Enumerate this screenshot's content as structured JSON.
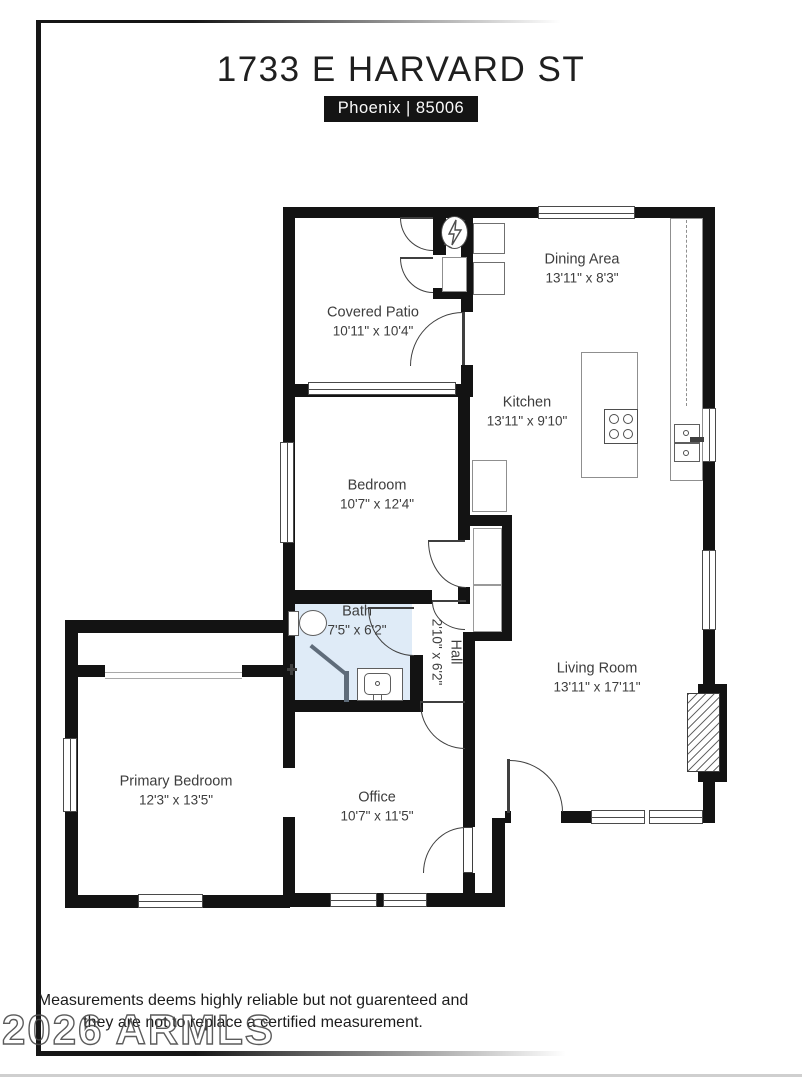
{
  "header": {
    "title": "1733 E HARVARD ST",
    "location": "Phoenix | 85006"
  },
  "rooms": [
    {
      "id": "covered-patio",
      "name": "Covered Patio",
      "dims": "10'11\" x 10'4\""
    },
    {
      "id": "dining-area",
      "name": "Dining Area",
      "dims": "13'11\" x 8'3\""
    },
    {
      "id": "kitchen",
      "name": "Kitchen",
      "dims": "13'11\" x 9'10\""
    },
    {
      "id": "bedroom",
      "name": "Bedroom",
      "dims": "10'7\" x 12'4\""
    },
    {
      "id": "bath",
      "name": "Bath",
      "dims": "7'5\" x 6'2\""
    },
    {
      "id": "hall",
      "name": "Hall",
      "dims": "2'10\" x 6'2\""
    },
    {
      "id": "living-room",
      "name": "Living Room",
      "dims": "13'11\" x 17'11\""
    },
    {
      "id": "primary-bedroom",
      "name": "Primary Bedroom",
      "dims": "12'3\" x 13'5\""
    },
    {
      "id": "office",
      "name": "Office",
      "dims": "10'7\" x 11'5\""
    }
  ],
  "footer": {
    "disclaimer_line1": "Measurements deems highly reliable but not guarenteed and",
    "disclaimer_line2": "they are not to replace a certified measurement.",
    "watermark": "2026 ARMLS"
  },
  "colors": {
    "wall": "#131313",
    "bath_fill": "#dfebf7",
    "badge_bg": "#141414",
    "fixture_outline": "#7d7d7d"
  }
}
